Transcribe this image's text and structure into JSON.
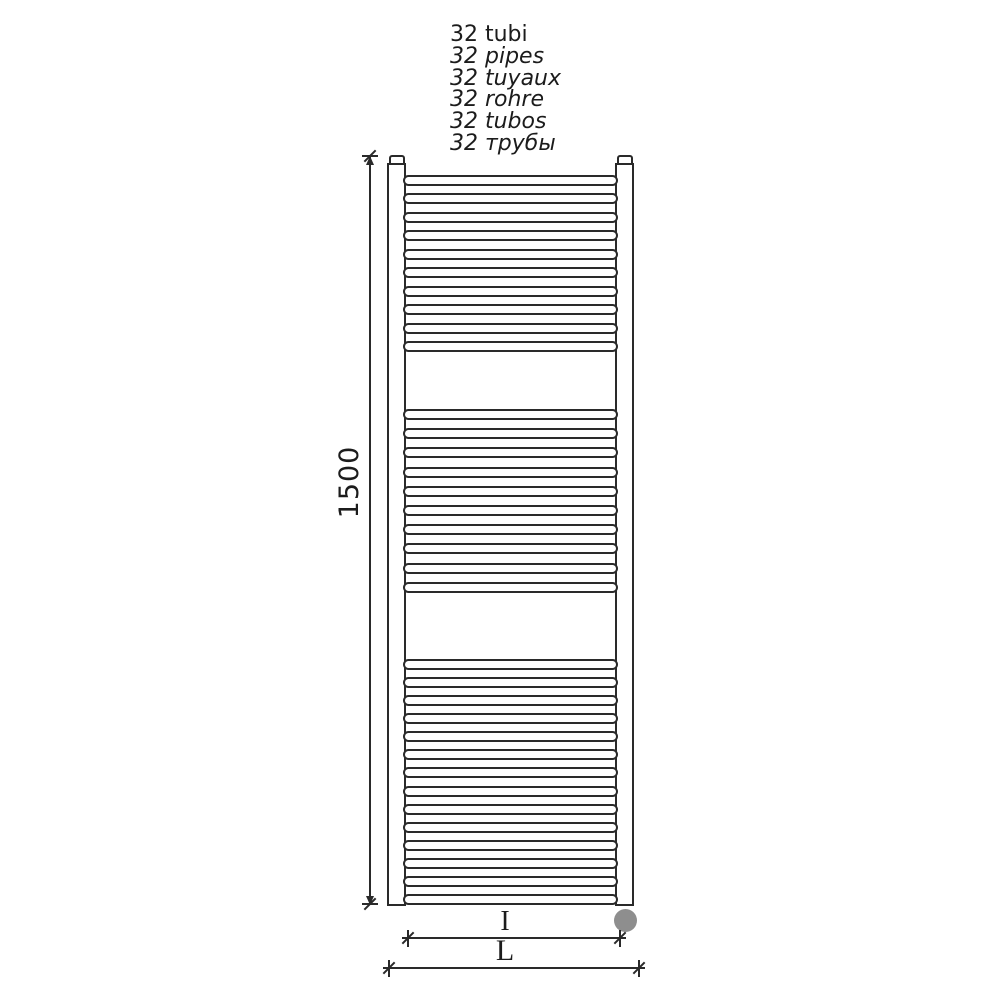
{
  "title_labels": [
    {
      "text": "32 tubi",
      "italic": false
    },
    {
      "text": "32 pipes",
      "italic": true
    },
    {
      "text": "32 tuyaux",
      "italic": true
    },
    {
      "text": "32 rohre",
      "italic": true
    },
    {
      "text": "32 tubos",
      "italic": true
    },
    {
      "text": "32 трубы",
      "italic": true
    }
  ],
  "dimensions": {
    "height_label": "1500",
    "inner_width_label": "I",
    "overall_width_label": "L"
  },
  "radiator": {
    "tube_groups": [
      {
        "count": 10,
        "start_y": 175,
        "pitch": 18.44
      },
      {
        "count": 10,
        "start_y": 409,
        "pitch": 19.2
      },
      {
        "count": 14,
        "start_y": 659,
        "pitch": 18.08
      }
    ]
  },
  "colors": {
    "line": "#2a2a2a",
    "element_dot": "#8e8e8e",
    "background": "#ffffff"
  }
}
